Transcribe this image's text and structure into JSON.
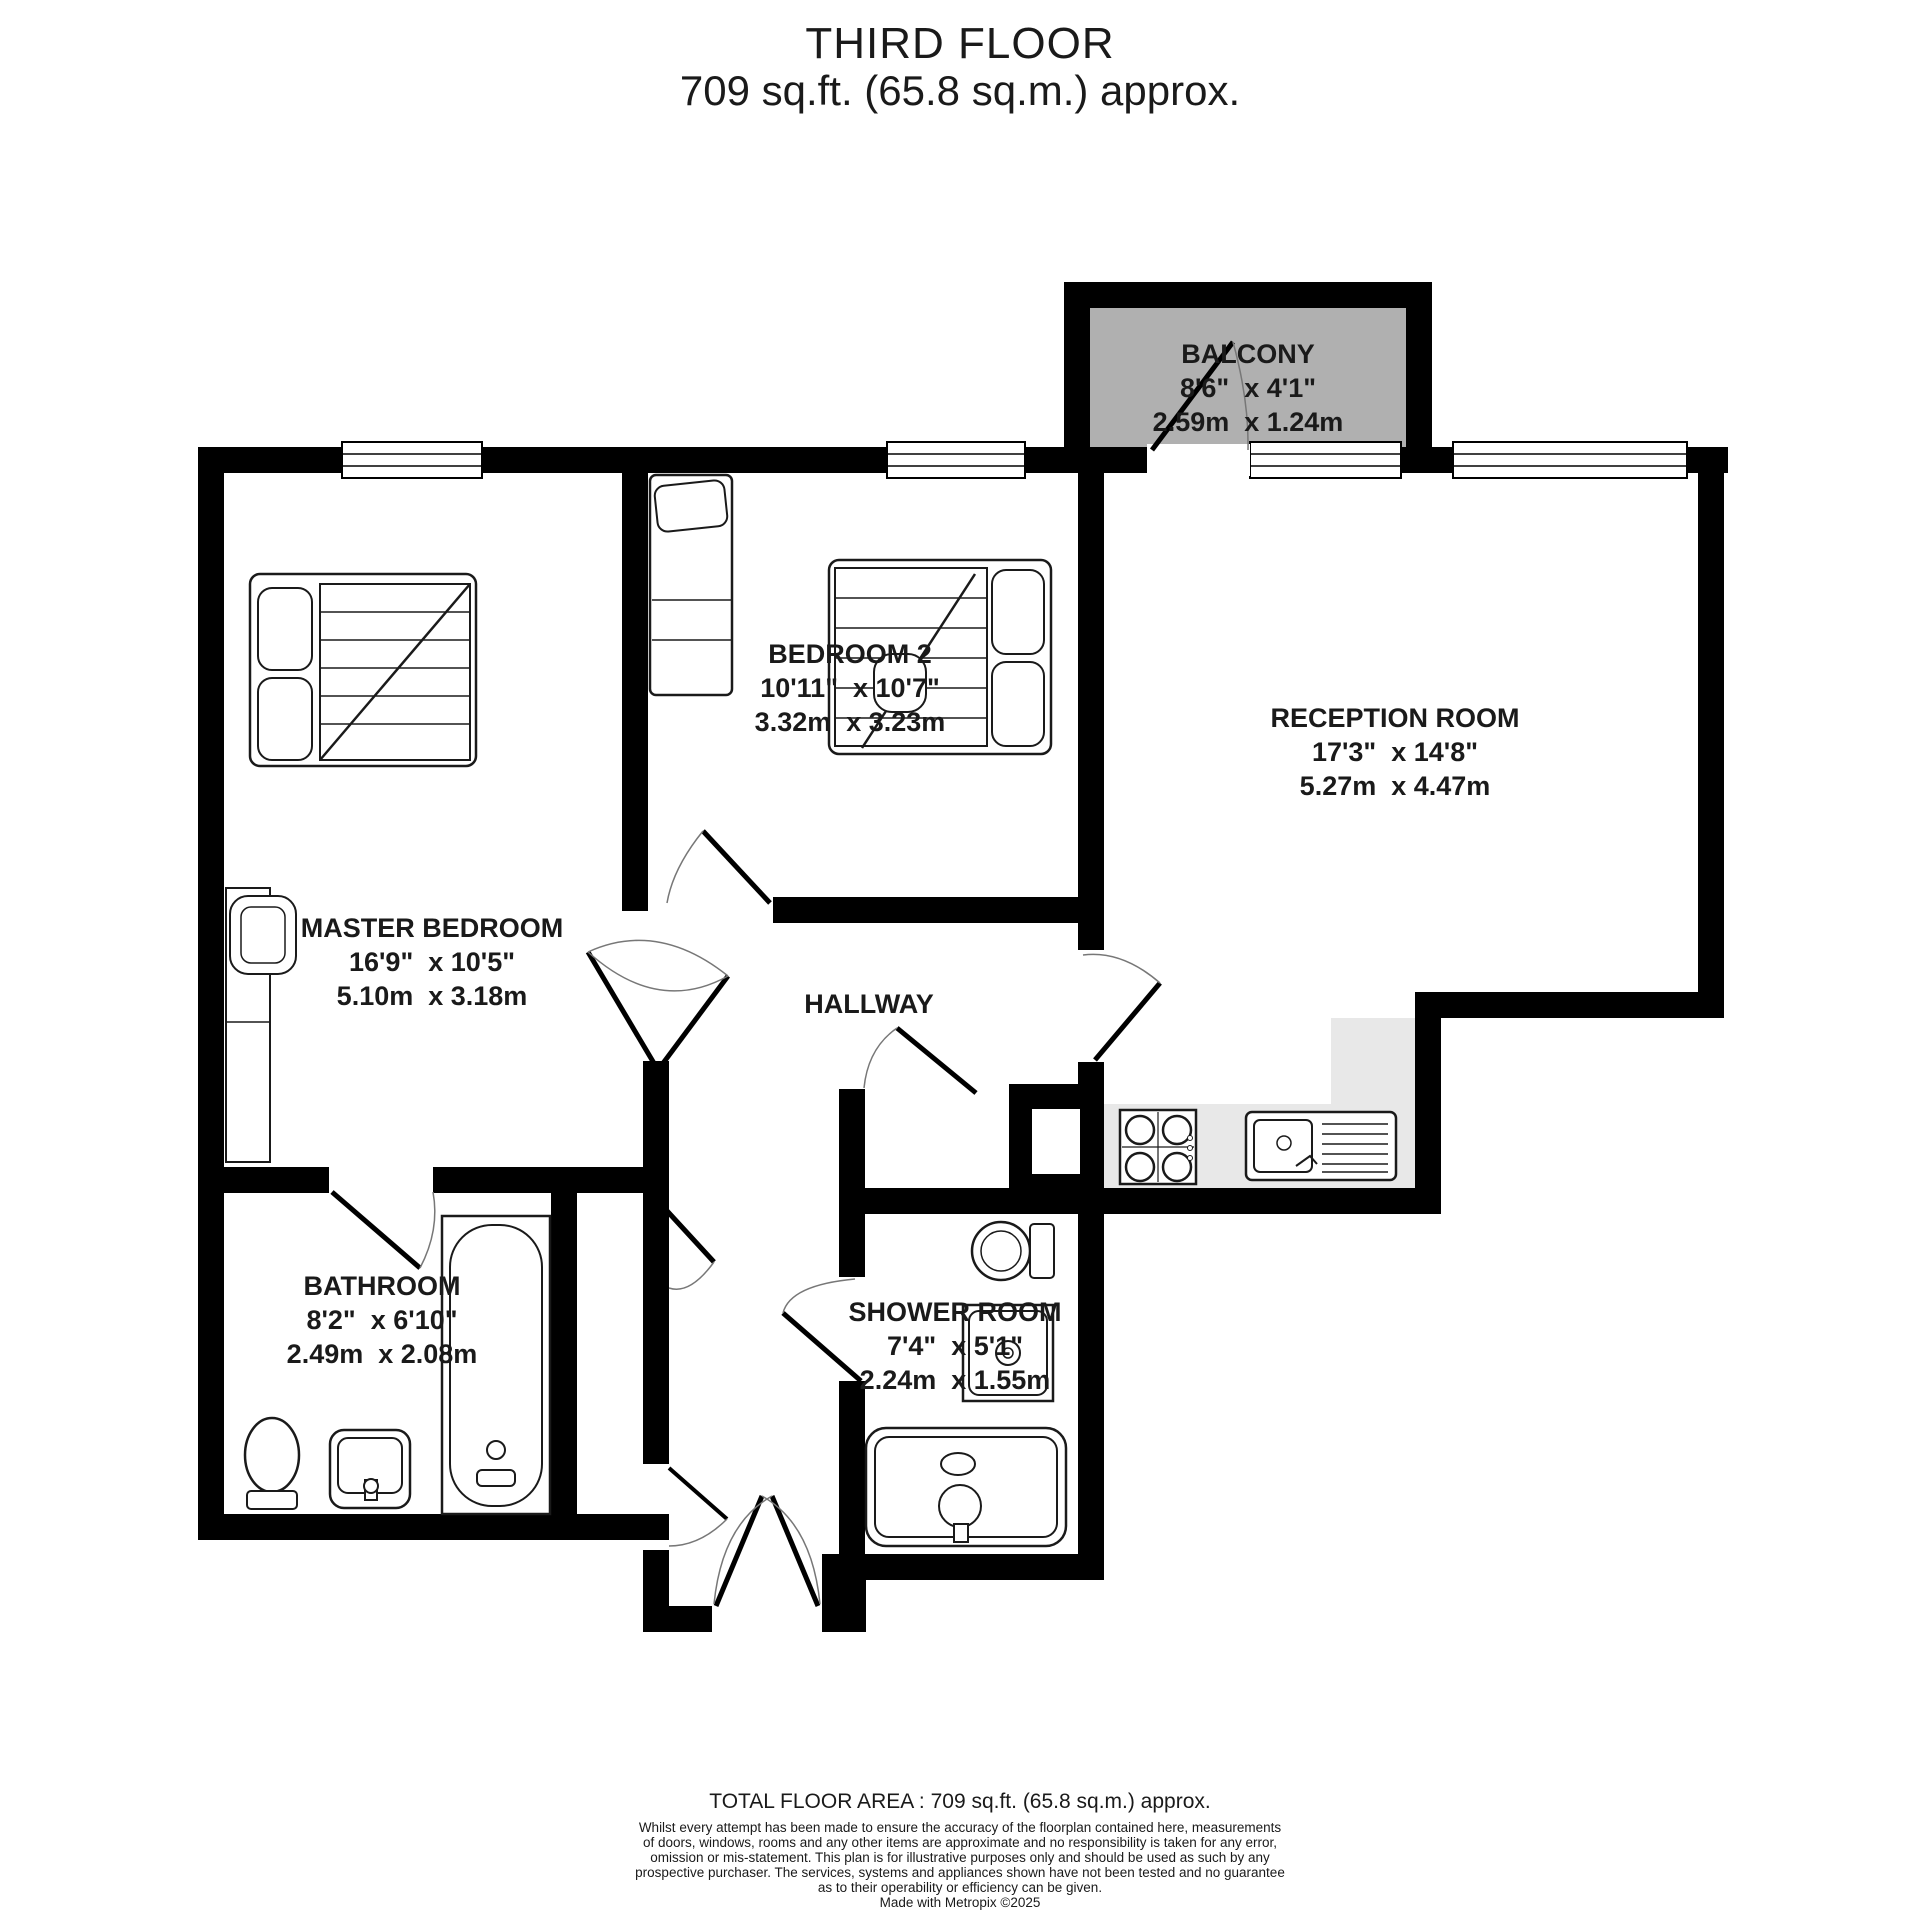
{
  "title": {
    "line1": "THIRD FLOOR",
    "line2": "709 sq.ft. (65.8 sq.m.) approx."
  },
  "rooms": {
    "balcony": {
      "name": "BALCONY",
      "imperial": "8'6\"  x 4'1\"",
      "metric": "2.59m  x 1.24m"
    },
    "bedroom2": {
      "name": "BEDROOM 2",
      "imperial": "10'11\"  x 10'7\"",
      "metric": "3.32m  x 3.23m"
    },
    "reception": {
      "name": "RECEPTION ROOM",
      "imperial": "17'3\"  x 14'8\"",
      "metric": "5.27m  x 4.47m"
    },
    "master": {
      "name": "MASTER BEDROOM",
      "imperial": "16'9\"  x 10'5\"",
      "metric": "5.10m  x 3.18m"
    },
    "hallway": {
      "name": "HALLWAY"
    },
    "bathroom": {
      "name": "BATHROOM",
      "imperial": "8'2\"  x 6'10\"",
      "metric": "2.49m  x 2.08m"
    },
    "shower": {
      "name": "SHOWER ROOM",
      "imperial": "7'4\"  x 5'1\"",
      "metric": "2.24m  x 1.55m"
    }
  },
  "footer": {
    "total": "TOTAL FLOOR AREA : 709 sq.ft. (65.8 sq.m.) approx.",
    "disclaimer": [
      "Whilst every attempt has been made to ensure the accuracy of the floorplan contained here, measurements",
      "of doors, windows, rooms and any other items are approximate and no responsibility is taken for any error,",
      "omission or mis-statement. This plan is for illustrative purposes only and should be used as such by any",
      "prospective purchaser. The services, systems and appliances shown have not been tested and no guarantee",
      "as to their operability or efficiency can be given.",
      "Made with Metropix ©2025"
    ]
  },
  "colors": {
    "wall": "#000000",
    "balcony_fill": "#b0b0b0",
    "kitchen_fill": "#e8e8e8",
    "text": "#1a1a1a"
  }
}
